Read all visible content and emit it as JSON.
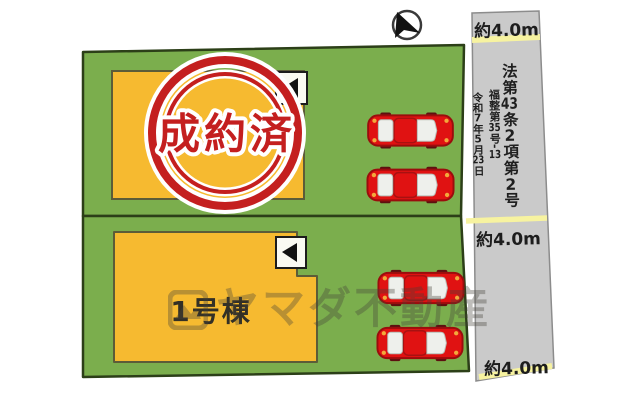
{
  "compass": {
    "icon": "north-arrow-icon"
  },
  "road": {
    "width_label_top": "約4.0m",
    "width_label_middle": "約4.0m",
    "width_label_bottom": "約4.0m",
    "legal_note": {
      "law_full": "法第43条2項第2号",
      "law_parts": [
        "法第",
        "43",
        "条",
        "2",
        "項第",
        "2",
        "号"
      ],
      "ref_full": "福整第35号-13",
      "ref_parts": [
        "福整第",
        "35",
        "号-",
        "13"
      ],
      "date_full": "令和7年5月23日",
      "date_parts": [
        "令和",
        "7",
        "年",
        "5",
        "月",
        "23",
        "日"
      ]
    }
  },
  "site": {
    "stamp": {
      "text": "成約済"
    },
    "building2_label": "1号棟",
    "icons": {
      "entrance_marker": "entrance-arrow-icon",
      "car": "car-top-view-icon"
    }
  },
  "watermark": {
    "text": "ヤマダ不動産",
    "icon": "photo-logo-icon"
  },
  "colors": {
    "plot_green": "#7bae4d",
    "plot_border": "#2c3f18",
    "building_orange": "#f6ba30",
    "road_gray": "#cacaca",
    "road_highlight_yellow": "#f7f3a0",
    "stamp_red": "#c41f1f",
    "car_red": "#e01212"
  }
}
